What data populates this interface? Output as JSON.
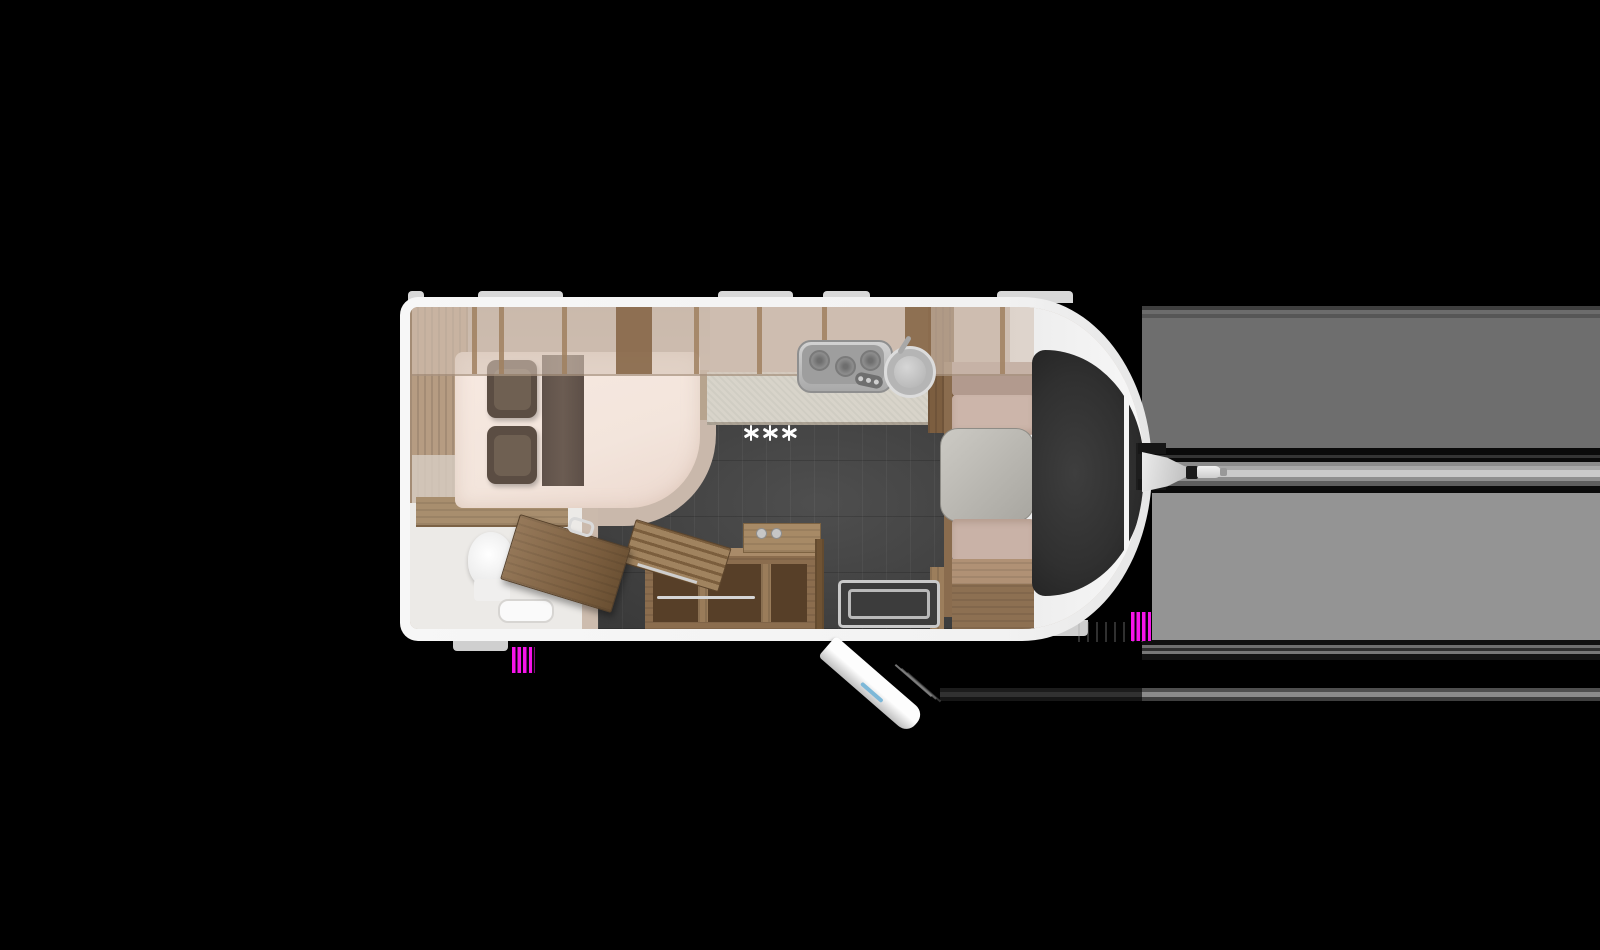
{
  "scene": {
    "description": "Top-down 3D floor plan of a single-axle caravan on a black background, hitch pointing right",
    "hob_marks": "***"
  },
  "colors": {
    "background": "#000000",
    "body_white": "#f4f4f4",
    "interior_beige": "#c6b5a8",
    "mattress": "#f3e5dc",
    "pillow_brown": "#5b4d43",
    "bed_runner": "#6b5c52",
    "wood_light": "#a98b69",
    "wood_mid": "#8b6d4e",
    "wood_dark": "#6f5334",
    "floor_dark": "#454545",
    "counter": "#d8d4ca",
    "cushion_mauve": "#ccb5aa",
    "cushion_back": "#b29a8e",
    "table_gray": "#bdbbb5",
    "window_dark": "#303030",
    "steel": "#c6c6c6",
    "bath_white": "#eceae7",
    "glitch_magenta": "#f714ea",
    "artifact_gray_dark": "#6e6e6e",
    "artifact_gray_light": "#949494"
  }
}
